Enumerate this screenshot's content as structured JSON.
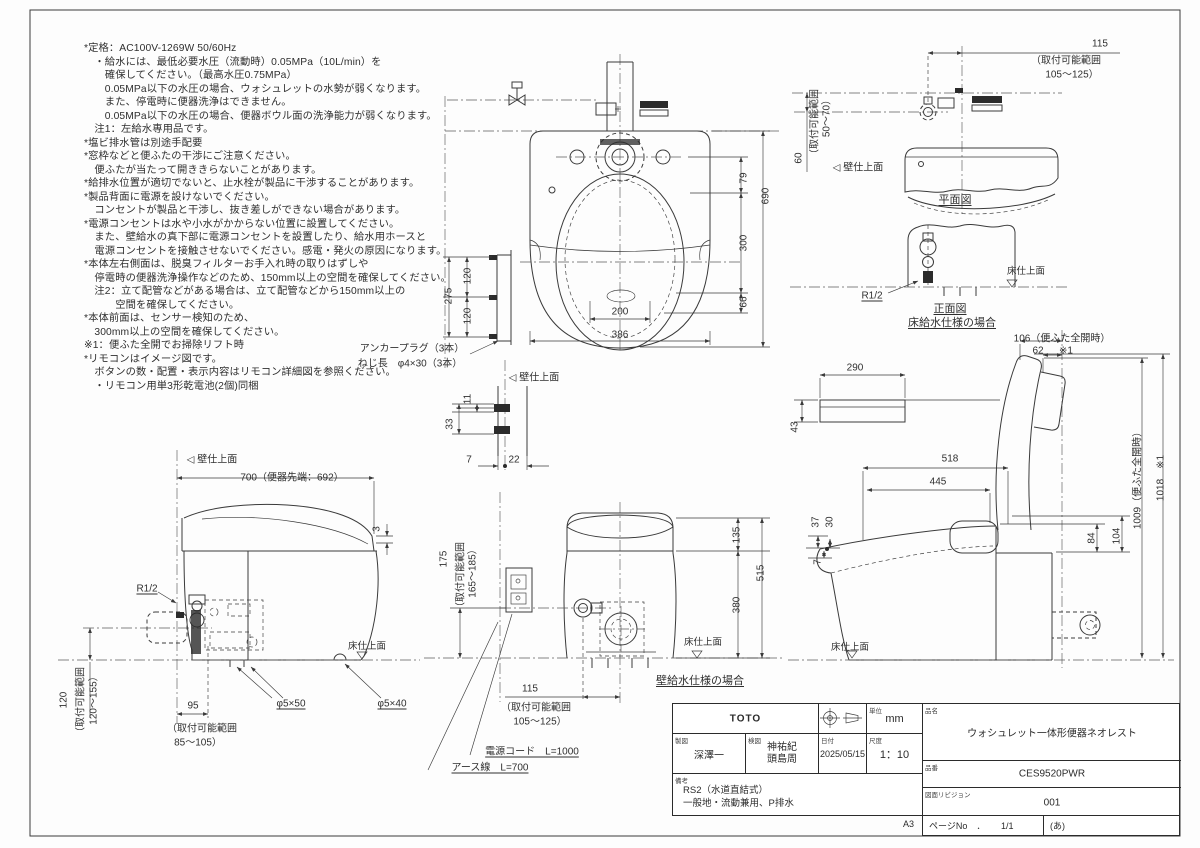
{
  "doc": {
    "type_note": "TOTO installation drawing"
  },
  "notes": {
    "lines": [
      "*定格：AC100V-1269W 50/60Hz",
      "　・給水には、最低必要水圧（流動時）0.05MPa（10L/min）を",
      "　　確保してください。（最高水圧0.75MPa）",
      "　　0.05MPa以下の水圧の場合、ウォシュレットの水勢が弱くなります。",
      "　　また、停電時に便器洗浄はできません。",
      "　　0.05MPa以下の水圧の場合、便器ボウル面の洗浄能力が弱くなります。",
      "　注1：左給水専用品です。",
      "*塩ビ排水管は別途手配要",
      "*窓枠などと便ふたの干渉にご注意ください。",
      "　便ふたが当たって開ききらないことがあります。",
      "*給排水位置が適切でないと、止水栓が製品に干渉することがあります。",
      "*製品背面に電源を設けないでください。",
      "　コンセントが製品と干渉し、抜き差しができない場合があります。",
      "*電源コンセントは水や小水がかからない位置に設置してください。",
      "　また、壁給水の真下部に電源コンセントを設置したり、給水用ホースと",
      "　電源コンセントを接触させないでください。感電・発火の原因になります。",
      "*本体左右側面は、脱臭フィルターお手入れ時の取りはずしや",
      "　停電時の便器洗浄操作などのため、150mm以上の空間を確保してください。",
      "　注2：立て配管などがある場合は、立て配管などから150mm以上の",
      "　　　空間を確保してください。",
      "*本体前面は、センサー検知のため、",
      "　300mm以上の空間を確保してください。",
      "※1：便ふた全開でお掃除リフト時",
      "*リモコンはイメージ図です。",
      "　ボタンの数・配置・表示内容はリモコン詳細図を参照ください。",
      "　・リモコン用単3形乾電池(2個)同梱"
    ]
  },
  "labels": [
    {
      "t": "115",
      "x": 1100,
      "y": 44
    },
    {
      "t": "（取付可能範囲",
      "x": 1066,
      "y": 59
    },
    {
      "t": "105～125）",
      "x": 1072,
      "y": 73
    },
    {
      "t": "60",
      "x": 799,
      "y": 158,
      "r": -90
    },
    {
      "t": "（取付可能範囲",
      "x": 813,
      "y": 124,
      "r": -90
    },
    {
      "t": "50～70）",
      "x": 825,
      "y": 116,
      "r": -90
    },
    {
      "t": "◁ 壁仕上面",
      "x": 858,
      "y": 166
    },
    {
      "t": "平面図",
      "x": 955,
      "y": 199,
      "u": 1,
      "s": 11
    },
    {
      "t": "R1/2",
      "x": 872,
      "y": 296,
      "u": 1
    },
    {
      "t": "正面図",
      "x": 950,
      "y": 308,
      "u": 1,
      "s": 11
    },
    {
      "t": "床給水仕様の場合",
      "x": 952,
      "y": 322,
      "u": 1,
      "s": 11
    },
    {
      "t": "床仕上面",
      "x": 1026,
      "y": 270,
      "s": 9.5
    },
    {
      "t": "79",
      "x": 744,
      "y": 178,
      "r": -90
    },
    {
      "t": "690",
      "x": 766,
      "y": 196,
      "r": -90
    },
    {
      "t": "300",
      "x": 744,
      "y": 243,
      "r": -90
    },
    {
      "t": "66",
      "x": 744,
      "y": 302,
      "r": -90
    },
    {
      "t": "200",
      "x": 620,
      "y": 312
    },
    {
      "t": "386",
      "x": 620,
      "y": 335
    },
    {
      "t": "275",
      "x": 449,
      "y": 296,
      "r": -90
    },
    {
      "t": "120",
      "x": 468,
      "y": 276,
      "r": -90
    },
    {
      "t": "120",
      "x": 468,
      "y": 316,
      "r": -90
    },
    {
      "t": "アンカープラグ（3本）",
      "x": 412,
      "y": 347
    },
    {
      "t": "ねじ長　φ4×30（3本）",
      "x": 410,
      "y": 362
    },
    {
      "t": "◁ 壁仕上面",
      "x": 534,
      "y": 376
    },
    {
      "t": "11",
      "x": 468,
      "y": 399,
      "r": -90
    },
    {
      "t": "33",
      "x": 450,
      "y": 424,
      "r": -90
    },
    {
      "t": "7",
      "x": 469,
      "y": 460
    },
    {
      "t": "22",
      "x": 514,
      "y": 460
    },
    {
      "t": "◁ 壁仕上面",
      "x": 212,
      "y": 458
    },
    {
      "t": "700（便器先端：692）",
      "x": 292,
      "y": 476
    },
    {
      "t": "3",
      "x": 377,
      "y": 529,
      "r": -90
    },
    {
      "t": "R1/2",
      "x": 147,
      "y": 589,
      "u": 1
    },
    {
      "t": "120",
      "x": 64,
      "y": 700,
      "r": -90
    },
    {
      "t": "（取付可能範囲",
      "x": 79,
      "y": 702,
      "r": -90
    },
    {
      "t": "120～155）",
      "x": 92,
      "y": 698,
      "r": -90
    },
    {
      "t": "95",
      "x": 193,
      "y": 706
    },
    {
      "t": "（取付可能範囲",
      "x": 202,
      "y": 727
    },
    {
      "t": "85～105）",
      "x": 198,
      "y": 741
    },
    {
      "t": "φ5×50",
      "x": 291,
      "y": 704,
      "u": 1
    },
    {
      "t": "φ5×40",
      "x": 392,
      "y": 704,
      "u": 1
    },
    {
      "t": "床仕上面",
      "x": 367,
      "y": 645,
      "s": 9.5
    },
    {
      "t": "175",
      "x": 444,
      "y": 559,
      "r": -90
    },
    {
      "t": "（取付可能範囲",
      "x": 459,
      "y": 577,
      "r": -90
    },
    {
      "t": "165～185）",
      "x": 471,
      "y": 571,
      "r": -90
    },
    {
      "t": "135",
      "x": 737,
      "y": 535,
      "r": -90
    },
    {
      "t": "380",
      "x": 737,
      "y": 605,
      "r": -90
    },
    {
      "t": "515",
      "x": 761,
      "y": 573,
      "r": -90
    },
    {
      "t": "床仕上面",
      "x": 703,
      "y": 641,
      "s": 9.5
    },
    {
      "t": "壁給水仕様の場合",
      "x": 700,
      "y": 680,
      "u": 1,
      "s": 11
    },
    {
      "t": "115",
      "x": 530,
      "y": 689
    },
    {
      "t": "（取付可能範囲",
      "x": 536,
      "y": 706
    },
    {
      "t": "105～125）",
      "x": 540,
      "y": 720
    },
    {
      "t": "電源コード　L=1000",
      "x": 532,
      "y": 750,
      "u": 1
    },
    {
      "t": "アース線　L=700",
      "x": 490,
      "y": 766,
      "u": 1
    },
    {
      "t": "106（便ふた全開時）",
      "x": 1062,
      "y": 337
    },
    {
      "t": "62",
      "x": 1038,
      "y": 351
    },
    {
      "t": "※1",
      "x": 1066,
      "y": 351
    },
    {
      "t": "290",
      "x": 855,
      "y": 368
    },
    {
      "t": "43",
      "x": 795,
      "y": 427,
      "r": -90
    },
    {
      "t": "518",
      "x": 950,
      "y": 459
    },
    {
      "t": "445",
      "x": 938,
      "y": 482
    },
    {
      "t": "1009（便ふた全開時）",
      "x": 1136,
      "y": 478,
      "r": -90
    },
    {
      "t": "1018　※1",
      "x": 1159,
      "y": 478,
      "r": -90
    },
    {
      "t": "37",
      "x": 816,
      "y": 522,
      "r": -90
    },
    {
      "t": "30",
      "x": 830,
      "y": 522,
      "r": -90
    },
    {
      "t": "7",
      "x": 818,
      "y": 562,
      "r": -90
    },
    {
      "t": "84",
      "x": 1092,
      "y": 538,
      "r": -90
    },
    {
      "t": "104",
      "x": 1117,
      "y": 536,
      "r": -90
    },
    {
      "t": "床仕上面",
      "x": 850,
      "y": 646,
      "s": 9.5
    }
  ],
  "title_block": {
    "brand": "TOTO",
    "unit_label": "単位",
    "unit": "mm",
    "drafter_label": "製図",
    "drafter": "深澤一",
    "checker_label": "検図",
    "checker_line1": "神祐紀",
    "checker_line2": "頭島周",
    "date_label": "日付",
    "date": "2025/05/15",
    "scale_label": "尺度",
    "scale": "1：10",
    "remarks_label": "備考",
    "remarks_line1": "RS2（水道直結式）",
    "remarks_line2": "一般地・流動兼用、P排水",
    "product_label": "品名",
    "product": "ウォシュレット一体形便器ネオレスト",
    "code_label": "品番",
    "code": "CES9520PWR",
    "revision_label": "図面リビジョン",
    "revision": "001",
    "paper_size": "A3",
    "page_label": "ページNo　．",
    "page": "1/1",
    "page_rev": "(あ)"
  }
}
